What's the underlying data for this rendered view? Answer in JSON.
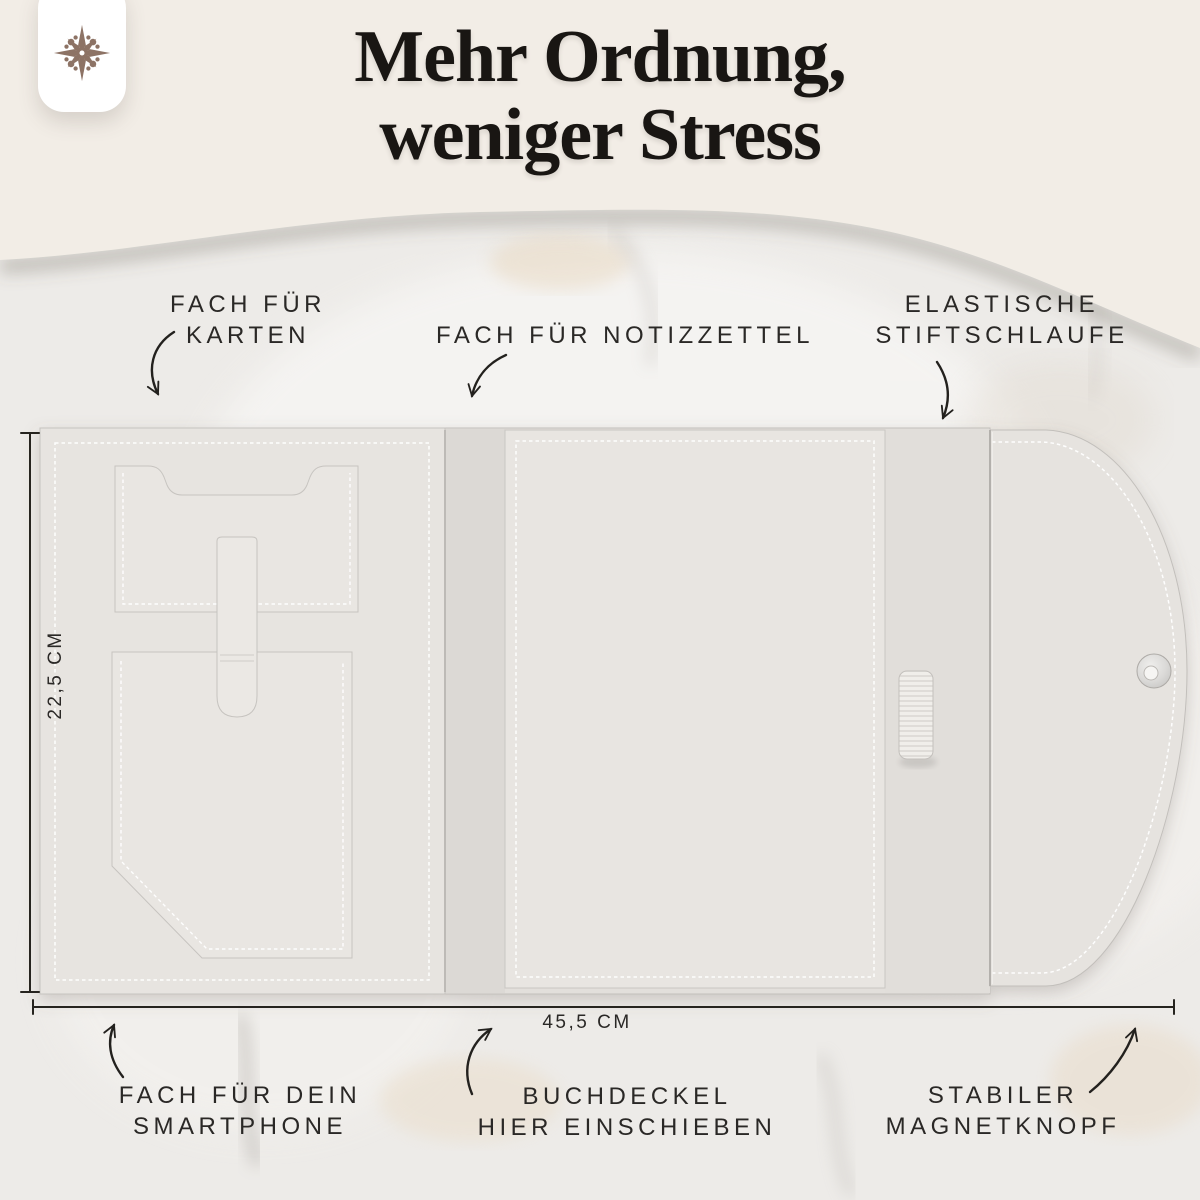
{
  "header": {
    "title_line1": "Mehr Ordnung,",
    "title_line2": "weniger Stress"
  },
  "logo": {
    "icon": "compass-ornament-icon"
  },
  "callouts": {
    "cards": [
      "FACH FÜR",
      "KARTEN"
    ],
    "notes": [
      "FACH FÜR NOTIZZETTEL"
    ],
    "pen_loop": [
      "ELASTISCHE",
      "STIFTSCHLAUFE"
    ],
    "smartphone": [
      "FACH FÜR DEIN",
      "SMARTPHONE"
    ],
    "book_cover": [
      "BUCHDECKEL",
      "HIER EINSCHIEBEN"
    ],
    "magnet": [
      "STABILER",
      "MAGNETKNOPF"
    ]
  },
  "dimensions": {
    "height": "22,5 CM",
    "width": "45,5 CM"
  },
  "colors": {
    "background_cream": "#f2ede6",
    "marble_base": "#edebe8",
    "leather": "#e7e4e0",
    "stitching": "#ffffff",
    "text_dark": "#2a2826",
    "title_dark": "#191613",
    "logo_brown": "#8d7365",
    "magnet_silver": "#d9d8d6"
  }
}
